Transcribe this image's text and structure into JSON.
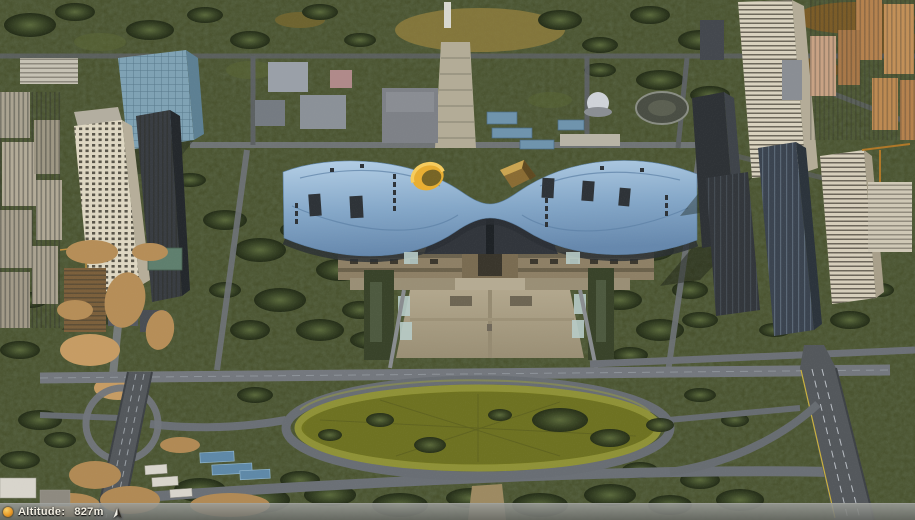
{
  "status_bar": {
    "altitude_label": "Altitude:",
    "altitude_value": "827m",
    "altitude_m": 827,
    "left_icon": "streaming-indicator-icon",
    "right_icon": "north-arrow-icon"
  },
  "colors": {
    "status_bar_bg": "#9a9c98",
    "status_text": "#f3efe3",
    "streaming_indicator": "#e89a28",
    "civic_roof_blue": "#8fb2d4",
    "roof_ring_yellow": "#e8ae32",
    "roof_dome_bronze": "#8a6c34",
    "plaza_tan": "#a89d84",
    "park_green": "#49522e",
    "road_gray": "#6e7276",
    "construction_dirt": "#b68e58"
  }
}
